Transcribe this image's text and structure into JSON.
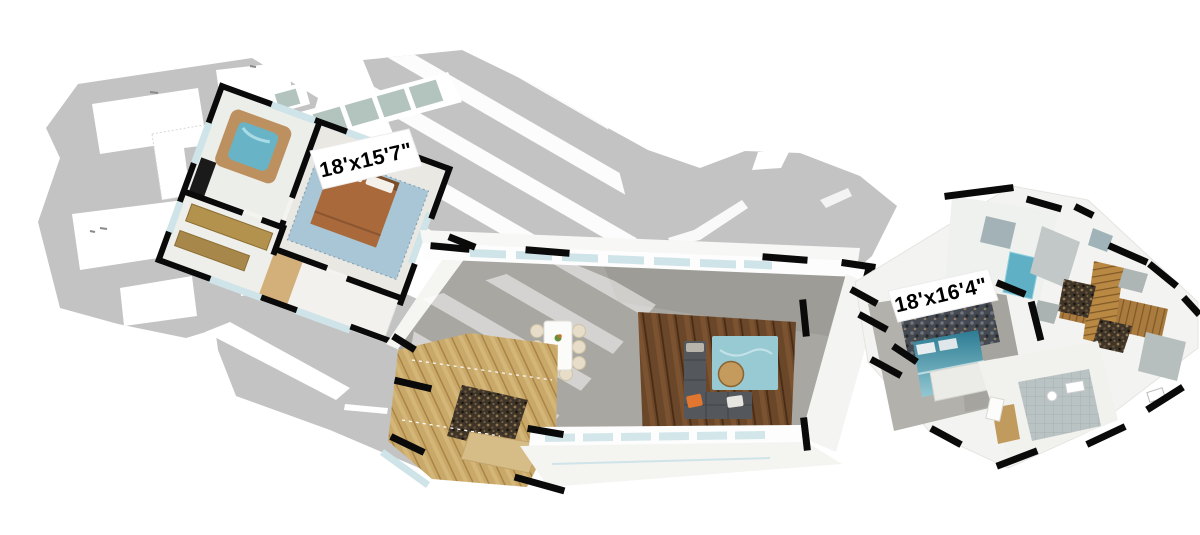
{
  "room_labels": [
    {
      "id": "left-bedroom-dimensions",
      "text": "18'x15'7\""
    },
    {
      "id": "right-bedroom-dimensions",
      "text": "18'x16'4\""
    }
  ],
  "palette": {
    "background": "#ffffff",
    "roof_deck_gray": "#c3c3c3",
    "wall_black": "#0a0a0a",
    "window_glass": "#cfe4e8",
    "skylight_glass": "#b3c4bf",
    "great_room_floor": "#a9a7a2",
    "hardwood_floor": "#6a4527",
    "kitchen_cabinet_wood": "#c9a96a",
    "kitchen_mosaic": "#3e3428",
    "living_rug_teal": "#98cad3",
    "sofa_gray": "#54575b",
    "pillow_orange": "#e0762f",
    "coffee_table_wood": "#c49a5d",
    "dining_chair_cream": "#e7ddc8",
    "left_bed_blanket_brown": "#a9693a",
    "left_bed_rug_blue": "#a9c6d6",
    "tub_water_blue": "#68b4c6",
    "tub_surround_tan": "#bd9060",
    "closet_shelf_gold": "#b2924d",
    "right_bed_teal": "#2e7d94",
    "stone_accent_wall": "#41464d",
    "entry_walkway_wood": "#a97b3e",
    "bath_tile_gray": "#bac3c3",
    "label_background": "#ffffff",
    "label_text": "#000000"
  }
}
